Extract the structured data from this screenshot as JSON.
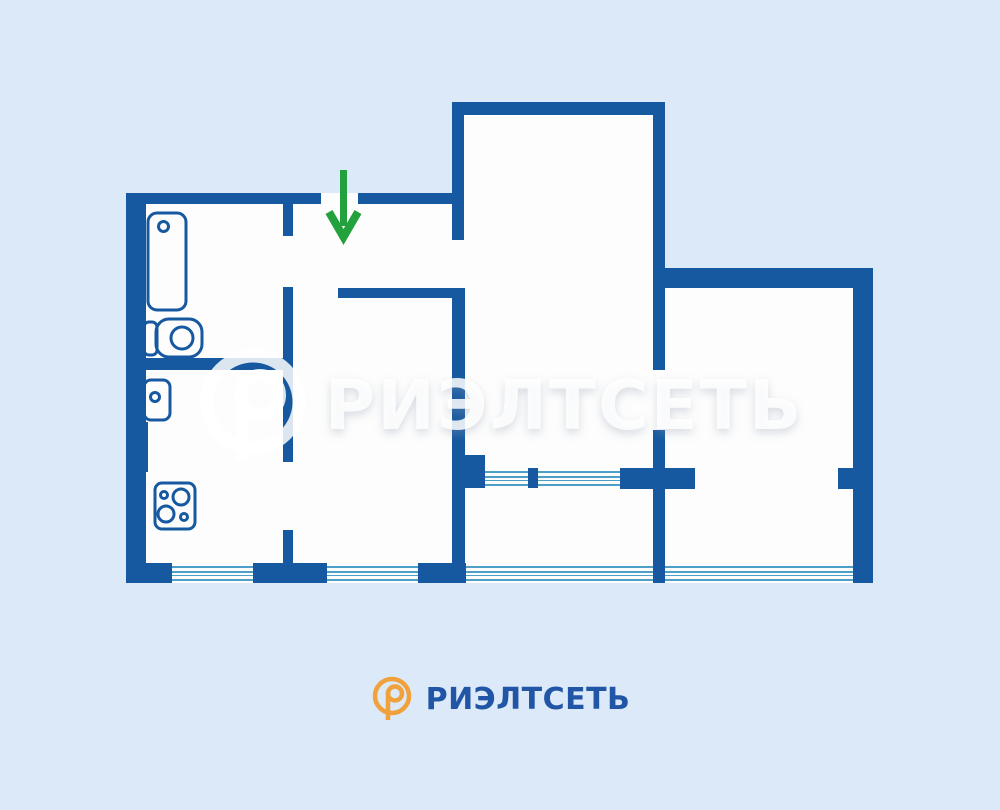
{
  "canvas": {
    "width": 1000,
    "height": 810
  },
  "palette": {
    "background": "#DCE9F8",
    "floor": "#FDFDFD",
    "wall": "#1659A0",
    "window_line": "#4D9FC7",
    "arrow_green": "#23A13D",
    "logo_orange": "#F0A13C",
    "logo_blue": "#2056A5",
    "watermark": "rgba(255,255,255,0.85)"
  },
  "watermark": {
    "brand": "РИЭЛТСЕТЬ"
  },
  "footer": {
    "brand": "РИЭЛТСЕТЬ"
  },
  "floorplan": {
    "rooms": [
      {
        "name": "left-block-floor",
        "rect": [
          126,
          193,
          340,
          390
        ]
      },
      {
        "name": "tall-room-floor",
        "rect": [
          452,
          102,
          213,
          481
        ]
      },
      {
        "name": "right-block-floor",
        "rect": [
          653,
          268,
          220,
          315
        ]
      }
    ],
    "windows": [
      {
        "name": "kitchen-window",
        "rect": [
          172,
          563,
          81,
          20
        ]
      },
      {
        "name": "room-window",
        "rect": [
          327,
          563,
          91,
          20
        ]
      },
      {
        "name": "balcony-block-window-left",
        "rect": [
          485,
          468,
          43,
          20
        ]
      },
      {
        "name": "balcony-block-window-right",
        "rect": [
          538,
          468,
          82,
          20
        ]
      },
      {
        "name": "loggia-glazing-center",
        "rect": [
          466,
          563,
          187,
          20
        ]
      },
      {
        "name": "loggia-glazing-right",
        "rect": [
          665,
          563,
          188,
          20
        ]
      }
    ],
    "walls": [
      {
        "name": "wall-exterior-left",
        "rect": [
          126,
          193,
          20,
          390
        ]
      },
      {
        "name": "wall-top-left",
        "rect": [
          126,
          193,
          195,
          11
        ]
      },
      {
        "name": "wall-top-right-of-entrance",
        "rect": [
          358,
          193,
          106,
          11
        ]
      },
      {
        "name": "wall-tall-room-top",
        "rect": [
          452,
          102,
          213,
          13
        ]
      },
      {
        "name": "wall-right-block-top",
        "rect": [
          653,
          268,
          220,
          20
        ]
      },
      {
        "name": "wall-exterior-right",
        "rect": [
          853,
          268,
          20,
          315
        ]
      },
      {
        "name": "wall-bottom-corner-left",
        "rect": [
          126,
          563,
          46,
          20
        ]
      },
      {
        "name": "wall-bottom-t-block",
        "rect": [
          253,
          563,
          74,
          20
        ]
      },
      {
        "name": "wall-bottom-l-block",
        "rect": [
          418,
          563,
          48,
          20
        ]
      },
      {
        "name": "wall-entrance-stub",
        "rect": [
          283,
          204,
          10,
          32
        ]
      },
      {
        "name": "wall-hallway-left",
        "rect": [
          283,
          287,
          10,
          175
        ]
      },
      {
        "name": "wall-kitchen-right-lower",
        "rect": [
          283,
          530,
          10,
          35
        ]
      },
      {
        "name": "wall-bathroom-bottom",
        "rect": [
          126,
          358,
          157,
          12
        ]
      },
      {
        "name": "wall-kitchen-step",
        "rect": [
          136,
          422,
          12,
          50
        ]
      },
      {
        "name": "wall-tall-room-left",
        "rect": [
          452,
          110,
          12,
          130
        ]
      },
      {
        "name": "wall-central",
        "rect": [
          452,
          288,
          13,
          277
        ]
      },
      {
        "name": "wall-hallway-bottom",
        "rect": [
          338,
          288,
          127,
          10
        ]
      },
      {
        "name": "wall-tall-room-right-upper",
        "rect": [
          653,
          110,
          12,
          260
        ]
      },
      {
        "name": "wall-tall-room-right-lower",
        "rect": [
          653,
          430,
          12,
          153
        ]
      },
      {
        "name": "wall-balcony-junction",
        "rect": [
          452,
          455,
          33,
          33
        ]
      },
      {
        "name": "wall-balcony-mullion",
        "rect": [
          528,
          468,
          10,
          20
        ]
      },
      {
        "name": "wall-balcony-solid",
        "rect": [
          620,
          468,
          75,
          21
        ]
      },
      {
        "name": "wall-right-room-stub",
        "rect": [
          838,
          468,
          15,
          21
        ]
      }
    ],
    "fixtures": [
      {
        "name": "bathtub-icon",
        "shapes": [
          {
            "t": "rect",
            "x": 148,
            "y": 213,
            "w": 38,
            "h": 97,
            "rx": 9
          },
          {
            "t": "circle",
            "cx": 163.5,
            "cy": 226.5,
            "r": 5
          }
        ]
      },
      {
        "name": "toilet-icon",
        "shapes": [
          {
            "t": "rect",
            "x": 144,
            "y": 322,
            "w": 13,
            "h": 33,
            "rx": 5
          },
          {
            "t": "rect",
            "x": 156,
            "y": 319,
            "w": 46,
            "h": 38,
            "rx": 13
          },
          {
            "t": "circle",
            "cx": 182,
            "cy": 338,
            "r": 11
          }
        ]
      },
      {
        "name": "sink-icon",
        "shapes": [
          {
            "t": "rect",
            "x": 144,
            "y": 380,
            "w": 26,
            "h": 40,
            "rx": 7
          },
          {
            "t": "circle",
            "cx": 155,
            "cy": 397,
            "r": 4.5
          }
        ]
      },
      {
        "name": "stove-icon",
        "shapes": [
          {
            "t": "rect",
            "x": 155,
            "y": 483,
            "w": 40,
            "h": 46,
            "rx": 7
          },
          {
            "t": "circle",
            "cx": 181,
            "cy": 497,
            "r": 8
          },
          {
            "t": "circle",
            "cx": 166,
            "cy": 514,
            "r": 8
          },
          {
            "t": "circle",
            "cx": 164,
            "cy": 495,
            "r": 3.5
          },
          {
            "t": "circle",
            "cx": 184,
            "cy": 517,
            "r": 3.5
          }
        ]
      }
    ],
    "entrance_arrow": {
      "name": "entrance-arrow",
      "color": "arrow_green",
      "shapes": [
        {
          "t": "line",
          "x1": 343.5,
          "y1": 170,
          "x2": 343.5,
          "y2": 226,
          "w": 7
        },
        {
          "t": "polyline",
          "points": "329,212 343.5,237 358,212",
          "w": 8
        }
      ]
    }
  }
}
